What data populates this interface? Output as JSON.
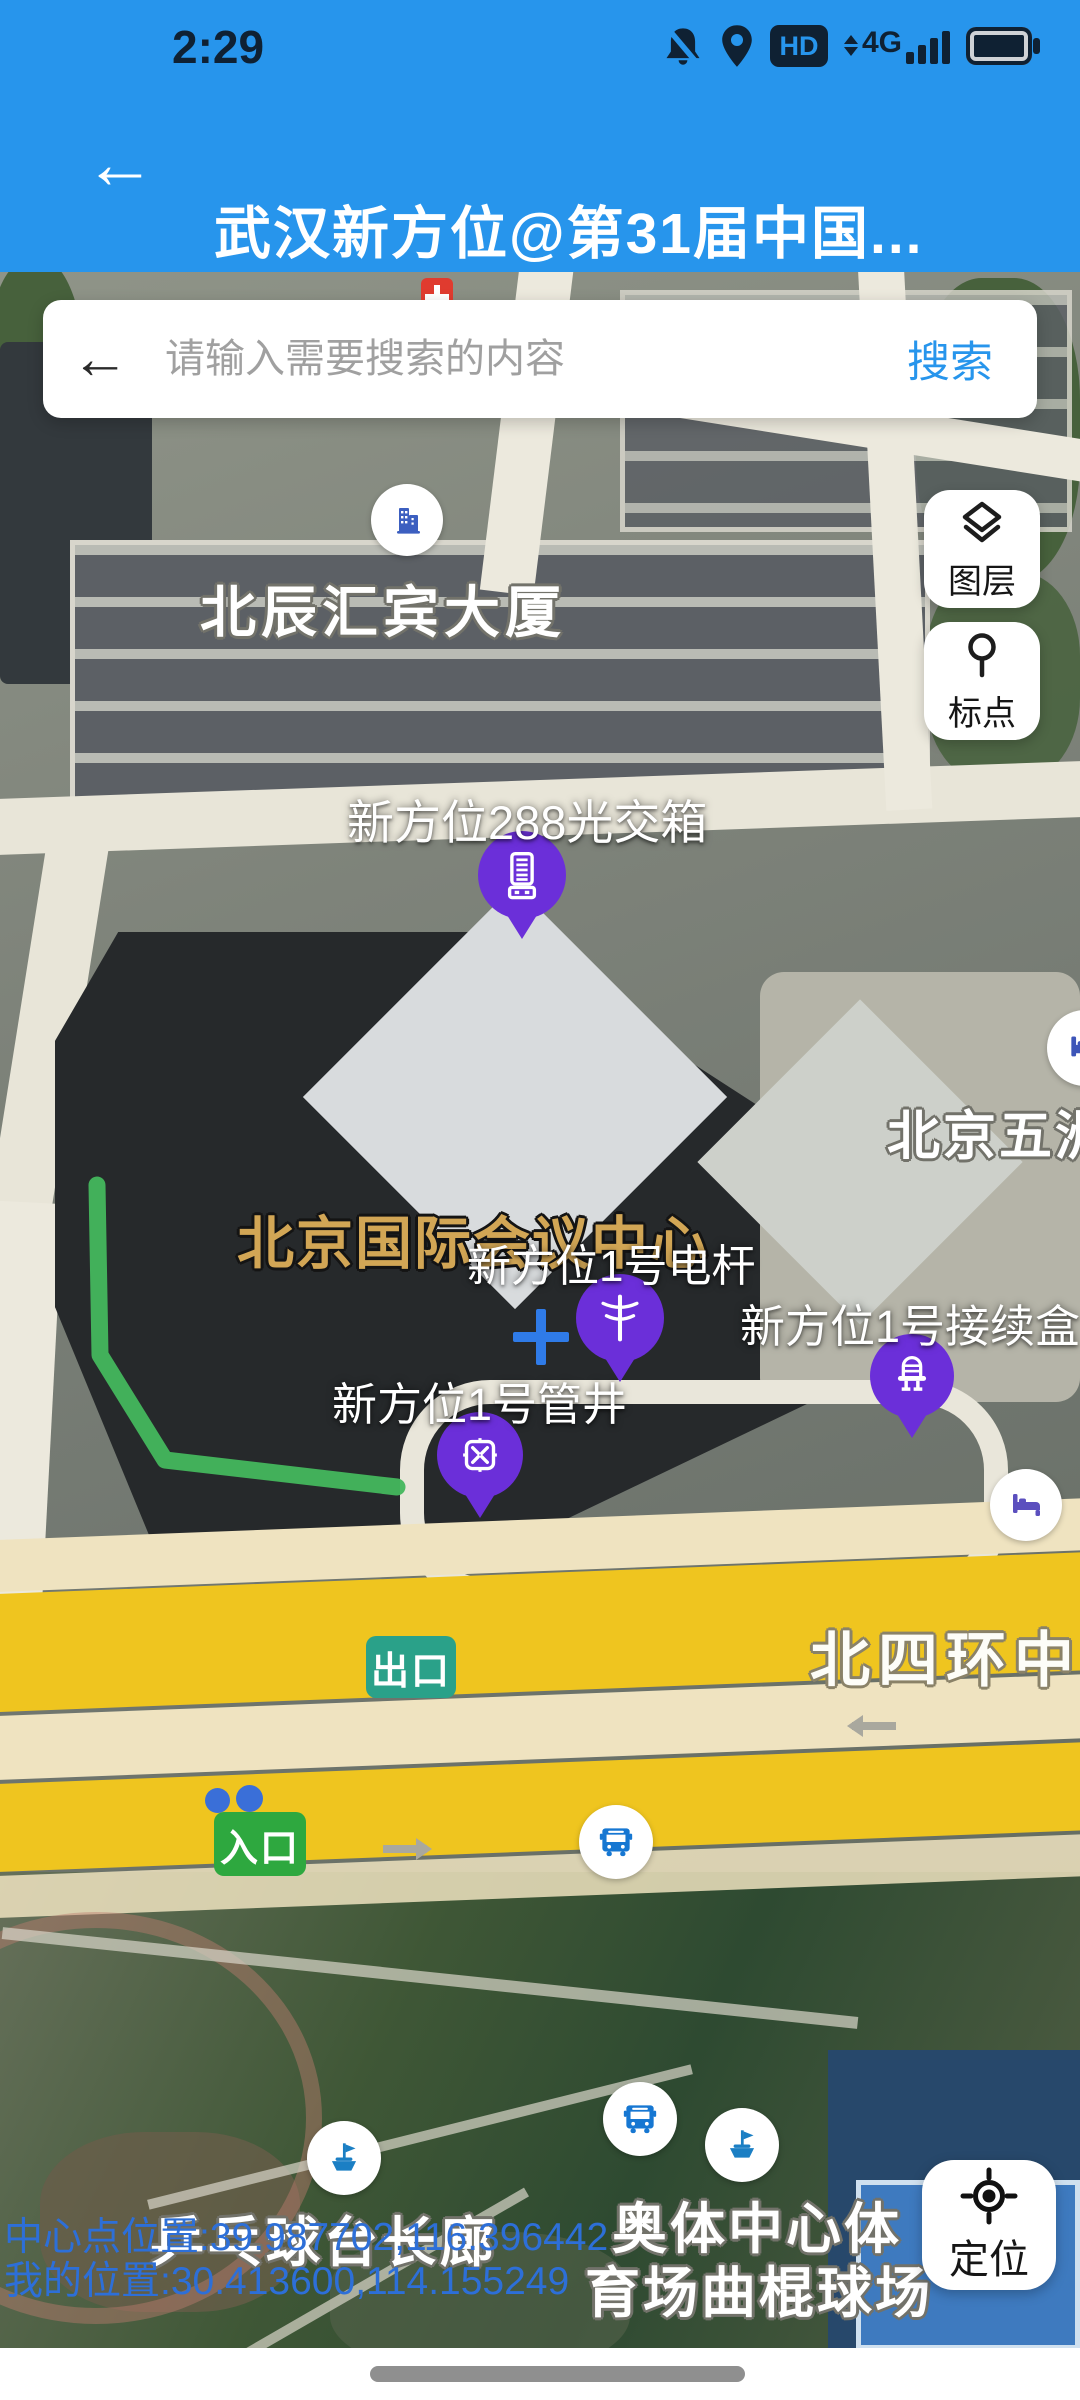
{
  "status_bar": {
    "time": "2:29",
    "hd_label": "HD",
    "network_label": "4G"
  },
  "header": {
    "back_glyph": "←",
    "title": "武汉新方位@第31届中国..."
  },
  "search": {
    "back_glyph": "←",
    "placeholder": "请输入需要搜索的内容",
    "button_label": "搜索"
  },
  "map_buttons": {
    "layers_label": "图层",
    "mark_label": "标点",
    "locate_label": "定位"
  },
  "road_badges": {
    "exit_label": "出口",
    "entrance_label": "入口"
  },
  "place_labels": {
    "beichen_tower": "北辰汇宾大厦",
    "conference_center": "北京国际会议中心",
    "wuzhou_hotel": "北京五洲",
    "ring_road": "北四环中",
    "pingpong_gallery": "乒乓球台长廊",
    "stadium_line1": "奥体中心体",
    "stadium_line2": "育场曲棍球场"
  },
  "asset_markers": [
    {
      "id": "fiber-cross-cabinet",
      "label": "新方位288光交箱"
    },
    {
      "id": "telegraph-pole",
      "label": "新方位1号电杆"
    },
    {
      "id": "splice-closure",
      "label": "新方位1号接续盒"
    },
    {
      "id": "pipe-well",
      "label": "新方位1号管井"
    }
  ],
  "status_readout": {
    "center_point": "中心点位置:39.987702,116.396442",
    "my_location": "我的位置:30.413600,114.155249"
  },
  "colors": {
    "header_blue": "#2795EC",
    "marker_purple": "#6B2FD9",
    "route_green": "#43B75D",
    "link_blue": "#2795EC",
    "coordinate_blue": "#2D6FD8",
    "road_yellow": "#EFC51F",
    "exit_badge_teal": "#2AA189",
    "entrance_badge_green": "#2EA83F",
    "bus_blue": "#1677D2"
  }
}
